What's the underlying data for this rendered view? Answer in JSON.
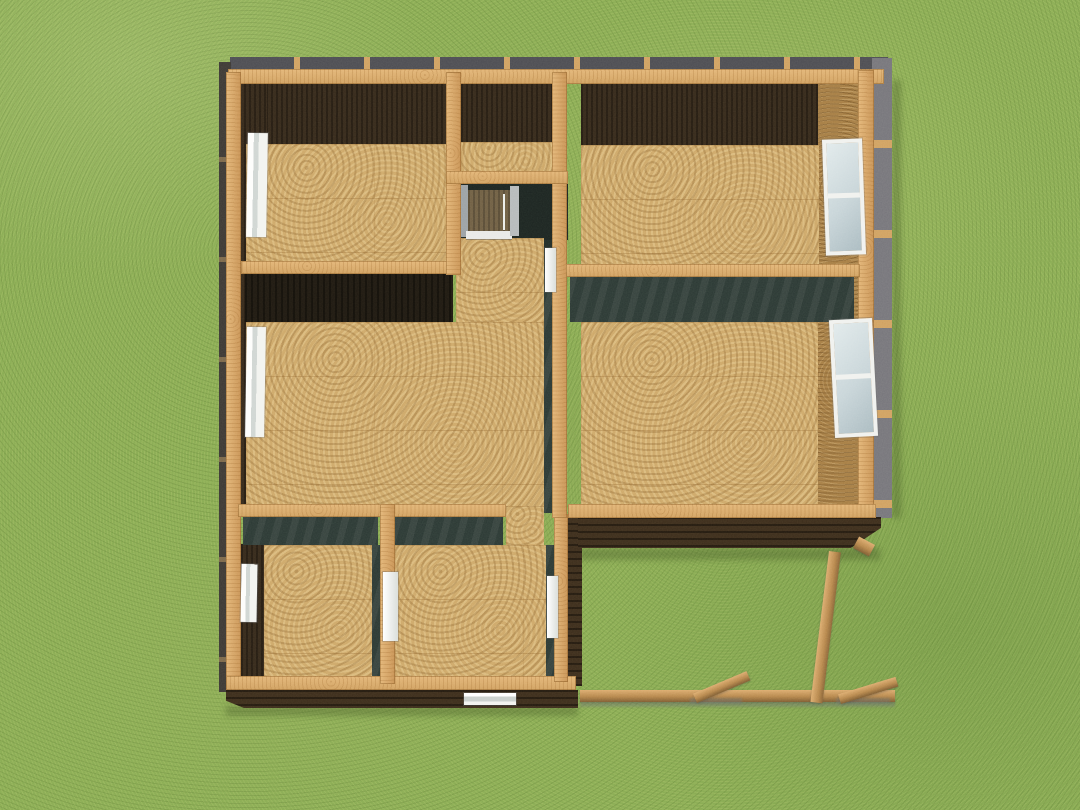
{
  "scene": {
    "type": "3d-model-render",
    "subject": "single-story house framing model seen from directly overhead on a grass lawn",
    "view": "aerial top-down with slight southern perspective",
    "footprint": "L-shaped; recessed bay at the lower right where deck framing sits on the lawn",
    "visible_text": ""
  },
  "palette": {
    "grass": "#87aa50",
    "grass_shade": "#6d8f3c",
    "grass_light": "#a3c06c",
    "floor_osb": "#cda768",
    "osb_speckle_dark": "#8a6233",
    "osb_speckle_light": "#ecd29a",
    "wall_sheathing_osb": "#a57c43",
    "top_plate_wood": "#d0a060",
    "deck_lumber": "#c8965a",
    "interior_face_brown": "#33271a",
    "interior_face_black": "#1d1811",
    "interior_face_slate": "#2a3733",
    "exterior_siding_brown": "#3a2b1b",
    "rim_gray_north": "#4b4b51",
    "rim_gray_east": "#75747a",
    "window_frame": "#f0f1ee",
    "window_glass": "#c7d4d8",
    "door_frame_gray": "#9aa0a4",
    "door_leaf_wood": "#6e5d42",
    "sill_white": "#e9e9e6"
  },
  "structure": {
    "rooms": [
      {
        "id": "room-northwest",
        "floor": "osb"
      },
      {
        "id": "closet-north-center",
        "floor": "osb"
      },
      {
        "id": "room-northeast",
        "floor": "osb"
      },
      {
        "id": "great-room-center",
        "floor": "osb"
      },
      {
        "id": "room-east-center",
        "floor": "osb"
      },
      {
        "id": "room-southwest",
        "floor": "osb"
      },
      {
        "id": "room-south-center",
        "floor": "osb"
      },
      {
        "id": "hallway-center",
        "floor": "osb"
      }
    ],
    "windows": [
      {
        "id": "window-west-north",
        "wall": "west"
      },
      {
        "id": "window-west-center",
        "wall": "west"
      },
      {
        "id": "window-west-south",
        "wall": "west"
      },
      {
        "id": "window-east-north",
        "wall": "east"
      },
      {
        "id": "window-east-center",
        "wall": "east"
      },
      {
        "id": "window-south",
        "wall": "south"
      }
    ],
    "doors": [
      {
        "id": "entry-door-north-center",
        "type": "wood leaf with gray frame and white sill"
      },
      {
        "id": "doorway-hall-upper",
        "type": "white cased opening"
      },
      {
        "id": "doorway-hall-lower",
        "type": "white cased opening"
      },
      {
        "id": "doorway-south-rooms",
        "type": "white cased opening"
      }
    ],
    "deck_framing": {
      "beams": 1,
      "posts": 1,
      "diagonal_braces": 2,
      "location": "lawn recess at lower right of house"
    }
  }
}
